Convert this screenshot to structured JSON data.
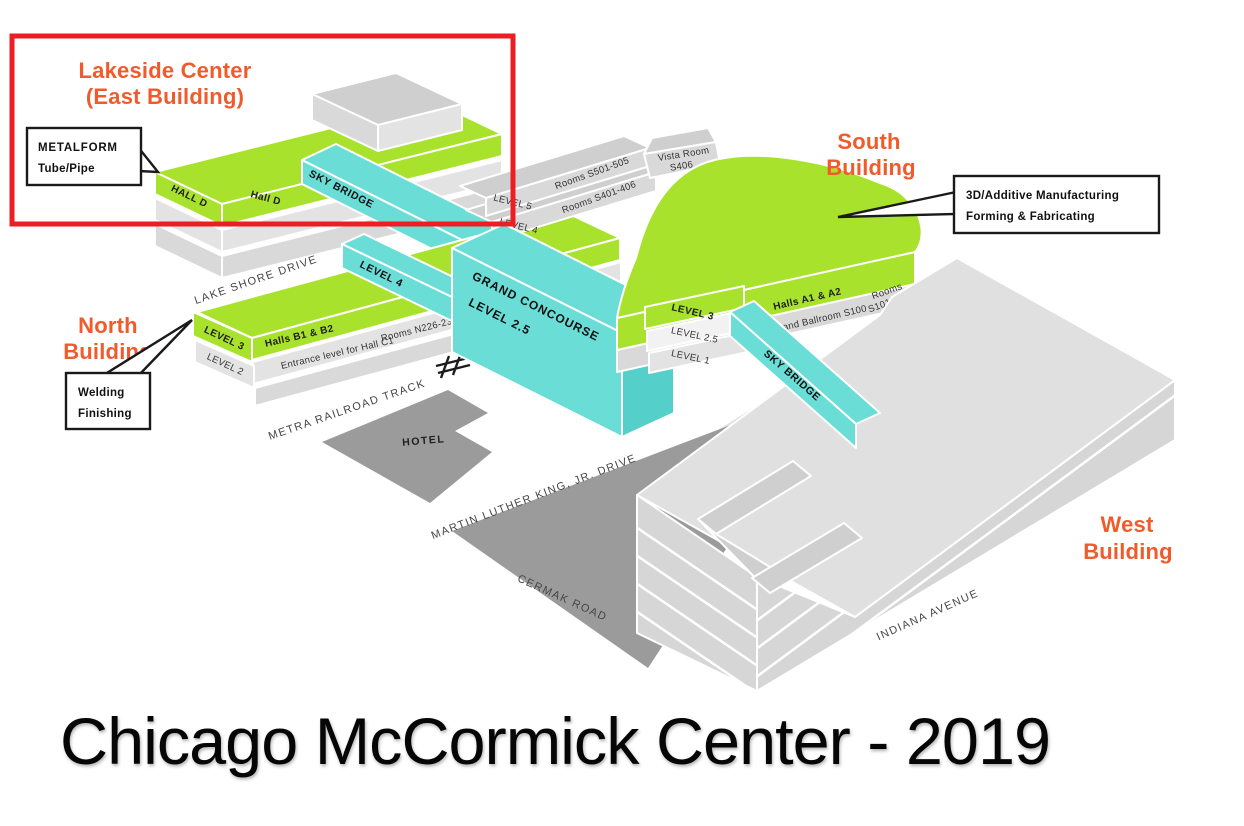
{
  "title": "Chicago McCormick Center - 2019",
  "colors": {
    "green": "#a9e22c",
    "cyan": "#69ddd6",
    "cyan_dark": "#55cfc9",
    "orange": "#f15b2b",
    "red": "#ee1d23"
  },
  "lakeside": {
    "title_line1": "Lakeside Center",
    "title_line2": "(East Building)",
    "hall_end": "HALL D",
    "hall_front": "Hall D"
  },
  "north": {
    "title_line1": "North",
    "title_line2": "Building",
    "level3": "LEVEL 3",
    "level2": "LEVEL 2",
    "halls": "Halls B1 & B2",
    "entrance": "Entrance level for Hall C1",
    "rooms": "Rooms N226-231"
  },
  "south": {
    "title_line1": "South",
    "title_line2": "Building",
    "level5": "LEVEL 5",
    "rooms_501": "Rooms S501-505",
    "level4": "LEVEL 4",
    "rooms_401": "Rooms S401-406",
    "vista_line1": "Vista Room",
    "vista_line2": "S406",
    "level3": "LEVEL 3",
    "level2_5": "LEVEL 2.5",
    "level1": "LEVEL 1",
    "halls": "Halls A1 & A2",
    "ballroom": "Grand Ballroom S100",
    "rooms_101_line1": "Rooms",
    "rooms_101_line2": "S101-106"
  },
  "west": {
    "title_line1": "West",
    "title_line2": "Building"
  },
  "concourse": {
    "line1": "GRAND CONCOURSE",
    "line2": "LEVEL 2.5",
    "wing": "LEVEL 4"
  },
  "bridges": {
    "north_bridge": "SKY BRIDGE",
    "south_bridge": "SKY BRIDGE"
  },
  "roads": {
    "lake_shore": "LAKE SHORE DRIVE",
    "metra": "METRA RAILROAD TRACK",
    "mlk": "MARTIN LUTHER KING, JR. DRIVE",
    "cermak": "CERMAK ROAD",
    "indiana": "INDIANA AVENUE"
  },
  "hotel_label": "HOTEL",
  "callouts": {
    "metalform": {
      "line1": "METALFORM",
      "line2": "Tube/Pipe"
    },
    "welding": {
      "line1": "Welding",
      "line2": "Finishing"
    },
    "additive": {
      "line1": "3D/Additive Manufacturing",
      "line2": "Forming & Fabricating"
    }
  }
}
